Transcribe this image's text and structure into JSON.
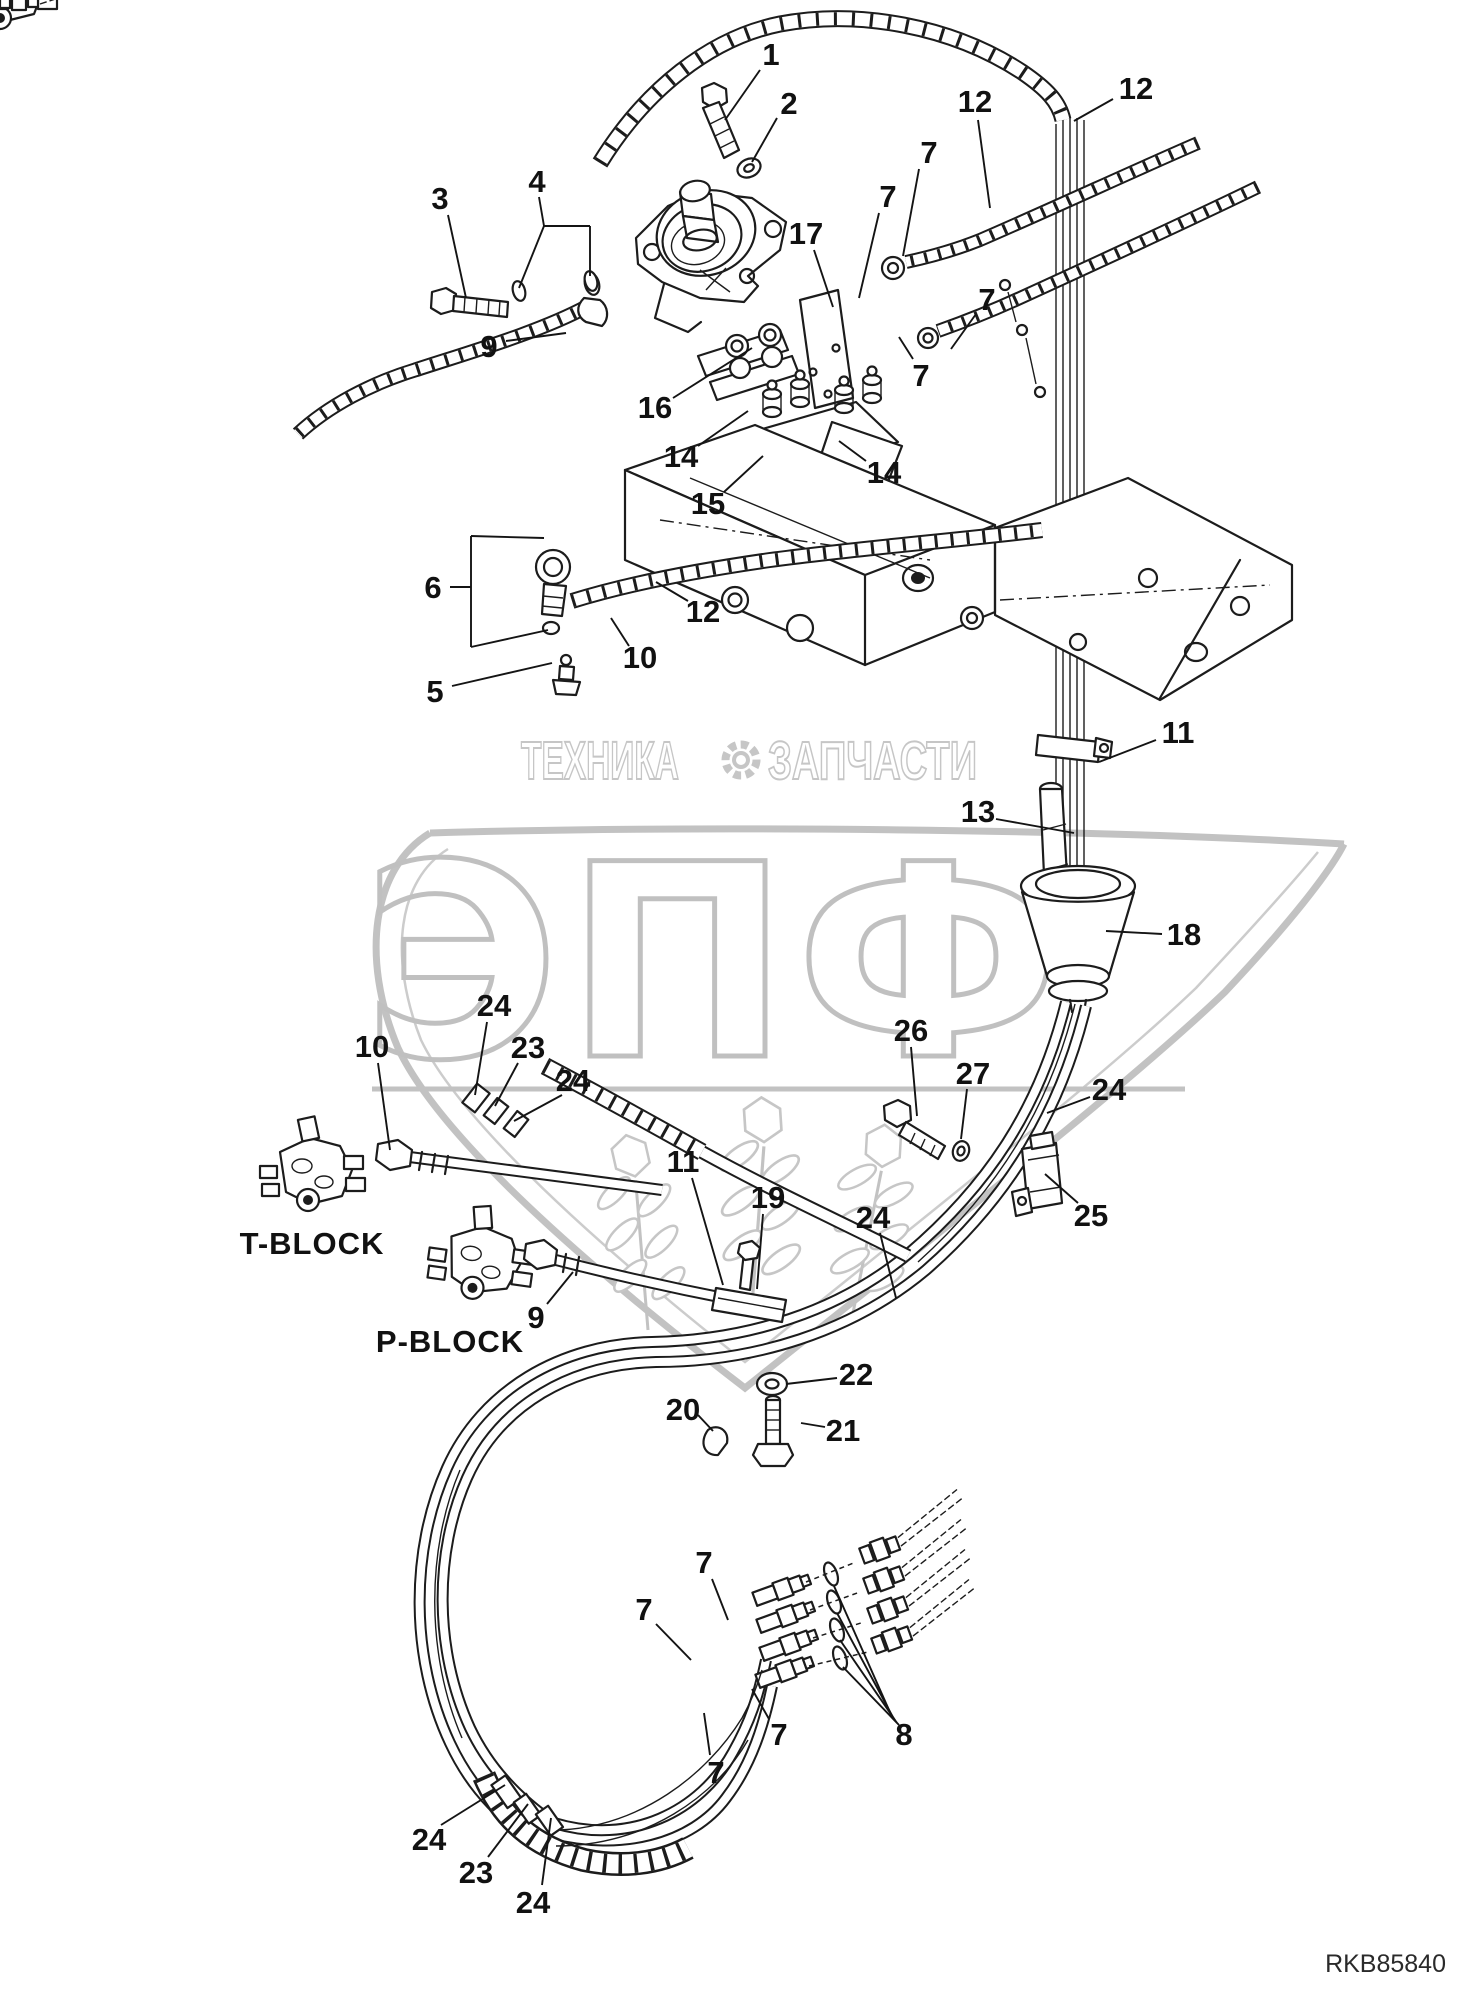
{
  "part_code": "RKB85840",
  "watermark": {
    "text_left": "ТЕХНИКА",
    "text_right": "ЗАПЧАСТИ",
    "text_big": "ЭПФ",
    "gear_icon": "gear-icon",
    "color": "#c2c2c2"
  },
  "block_labels": [
    {
      "label": "T-BLOCK",
      "x": 312,
      "y": 1243
    },
    {
      "label": "P-BLOCK",
      "x": 450,
      "y": 1341
    }
  ],
  "callouts": [
    {
      "label": "1",
      "x": 771,
      "y": 54,
      "leaders": [
        [
          760,
          70,
          725,
          120
        ]
      ]
    },
    {
      "label": "2",
      "x": 789,
      "y": 103,
      "leaders": [
        [
          777,
          118,
          752,
          162
        ]
      ]
    },
    {
      "label": "12",
      "x": 1136,
      "y": 88,
      "leaders": [
        [
          1113,
          99,
          1074,
          121
        ]
      ]
    },
    {
      "label": "12",
      "x": 975,
      "y": 101,
      "leaders": [
        [
          978,
          120,
          990,
          208
        ]
      ]
    },
    {
      "label": "7",
      "x": 929,
      "y": 152,
      "leaders": [
        [
          919,
          169,
          903,
          256
        ]
      ]
    },
    {
      "label": "7",
      "x": 888,
      "y": 196,
      "leaders": [
        [
          879,
          213,
          859,
          298
        ]
      ]
    },
    {
      "label": "17",
      "x": 806,
      "y": 233,
      "leaders": [
        [
          814,
          250,
          833,
          307
        ]
      ]
    },
    {
      "label": "3",
      "x": 440,
      "y": 198,
      "leaders": [
        [
          448,
          215,
          466,
          298
        ]
      ]
    },
    {
      "label": "4",
      "x": 537,
      "y": 181,
      "leaders": [
        [
          539,
          197,
          544,
          226
        ],
        [
          544,
          226,
          519,
          288
        ],
        [
          544,
          226,
          590,
          226
        ],
        [
          590,
          226,
          590,
          276
        ]
      ]
    },
    {
      "label": "7",
      "x": 987,
      "y": 299,
      "leaders": [
        [
          976,
          314,
          951,
          349
        ]
      ]
    },
    {
      "label": "7",
      "x": 921,
      "y": 375,
      "leaders": [
        [
          913,
          359,
          899,
          337
        ]
      ]
    },
    {
      "label": "9",
      "x": 489,
      "y": 346,
      "leaders": [
        [
          506,
          341,
          566,
          333
        ]
      ]
    },
    {
      "label": "16",
      "x": 655,
      "y": 407,
      "leaders": [
        [
          673,
          398,
          752,
          348
        ]
      ]
    },
    {
      "label": "14",
      "x": 681,
      "y": 456,
      "leaders": [
        [
          698,
          446,
          748,
          411
        ]
      ]
    },
    {
      "label": "15",
      "x": 708,
      "y": 503,
      "leaders": [
        [
          724,
          492,
          763,
          456
        ]
      ]
    },
    {
      "label": "14",
      "x": 884,
      "y": 472,
      "leaders": [
        [
          866,
          461,
          839,
          441
        ]
      ]
    },
    {
      "label": "6",
      "x": 433,
      "y": 587,
      "leaders": [
        [
          450,
          587,
          471,
          587
        ],
        [
          471,
          536,
          471,
          647
        ],
        [
          471,
          536,
          544,
          538
        ],
        [
          471,
          647,
          548,
          630
        ]
      ]
    },
    {
      "label": "12",
      "x": 703,
      "y": 611,
      "leaders": [
        [
          688,
          601,
          656,
          582
        ]
      ]
    },
    {
      "label": "10",
      "x": 640,
      "y": 657,
      "leaders": [
        [
          629,
          646,
          611,
          618
        ]
      ]
    },
    {
      "label": "5",
      "x": 435,
      "y": 691,
      "leaders": [
        [
          452,
          686,
          552,
          663
        ]
      ]
    },
    {
      "label": "11",
      "x": 1178,
      "y": 732,
      "leaders": [
        [
          1156,
          740,
          1099,
          762
        ]
      ]
    },
    {
      "label": "13",
      "x": 978,
      "y": 811,
      "leaders": [
        [
          996,
          819,
          1074,
          833
        ]
      ]
    },
    {
      "label": "18",
      "x": 1184,
      "y": 934,
      "leaders": [
        [
          1162,
          934,
          1106,
          931
        ]
      ]
    },
    {
      "label": "24",
      "x": 494,
      "y": 1005,
      "leaders": [
        [
          487,
          1022,
          475,
          1095
        ]
      ]
    },
    {
      "label": "23",
      "x": 528,
      "y": 1047,
      "leaders": [
        [
          518,
          1063,
          495,
          1106
        ]
      ]
    },
    {
      "label": "24",
      "x": 573,
      "y": 1080,
      "leaders": [
        [
          562,
          1095,
          514,
          1121
        ]
      ]
    },
    {
      "label": "10",
      "x": 372,
      "y": 1046,
      "leaders": [
        [
          378,
          1063,
          390,
          1150
        ]
      ]
    },
    {
      "label": "9",
      "x": 536,
      "y": 1317,
      "leaders": [
        [
          547,
          1304,
          573,
          1272
        ]
      ]
    },
    {
      "label": "11",
      "x": 683,
      "y": 1161,
      "leaders": [
        [
          692,
          1178,
          723,
          1285
        ]
      ]
    },
    {
      "label": "19",
      "x": 768,
      "y": 1197,
      "leaders": [
        [
          763,
          1214,
          757,
          1289
        ]
      ]
    },
    {
      "label": "24",
      "x": 873,
      "y": 1217,
      "leaders": [
        [
          880,
          1233,
          896,
          1298
        ]
      ]
    },
    {
      "label": "26",
      "x": 911,
      "y": 1030,
      "leaders": [
        [
          911,
          1047,
          917,
          1116
        ]
      ]
    },
    {
      "label": "27",
      "x": 973,
      "y": 1073,
      "leaders": [
        [
          967,
          1089,
          961,
          1139
        ]
      ]
    },
    {
      "label": "24",
      "x": 1109,
      "y": 1089,
      "leaders": [
        [
          1090,
          1097,
          1047,
          1113
        ]
      ]
    },
    {
      "label": "25",
      "x": 1091,
      "y": 1215,
      "leaders": [
        [
          1078,
          1203,
          1045,
          1174
        ]
      ]
    },
    {
      "label": "22",
      "x": 856,
      "y": 1374,
      "leaders": [
        [
          837,
          1378,
          786,
          1384
        ]
      ]
    },
    {
      "label": "21",
      "x": 843,
      "y": 1430,
      "leaders": [
        [
          825,
          1427,
          801,
          1423
        ]
      ]
    },
    {
      "label": "20",
      "x": 683,
      "y": 1409,
      "leaders": [
        [
          698,
          1415,
          713,
          1431
        ]
      ]
    },
    {
      "label": "7",
      "x": 704,
      "y": 1562,
      "leaders": [
        [
          712,
          1579,
          728,
          1620
        ]
      ]
    },
    {
      "label": "7",
      "x": 644,
      "y": 1609,
      "leaders": [
        [
          656,
          1624,
          691,
          1660
        ]
      ]
    },
    {
      "label": "7",
      "x": 779,
      "y": 1734,
      "leaders": [
        [
          769,
          1719,
          752,
          1689
        ]
      ]
    },
    {
      "label": "7",
      "x": 716,
      "y": 1772,
      "leaders": [
        [
          710,
          1755,
          704,
          1713
        ]
      ]
    },
    {
      "label": "8",
      "x": 904,
      "y": 1734,
      "leaders": [
        [
          893,
          1719,
          834,
          1586
        ],
        [
          895,
          1721,
          837,
          1613
        ],
        [
          897,
          1723,
          840,
          1640
        ],
        [
          899,
          1725,
          843,
          1667
        ]
      ]
    },
    {
      "label": "24",
      "x": 429,
      "y": 1839,
      "leaders": [
        [
          441,
          1825,
          505,
          1785
        ]
      ]
    },
    {
      "label": "23",
      "x": 476,
      "y": 1872,
      "leaders": [
        [
          488,
          1857,
          528,
          1804
        ]
      ]
    },
    {
      "label": "24",
      "x": 533,
      "y": 1902,
      "leaders": [
        [
          542,
          1885,
          551,
          1818
        ]
      ]
    }
  ]
}
